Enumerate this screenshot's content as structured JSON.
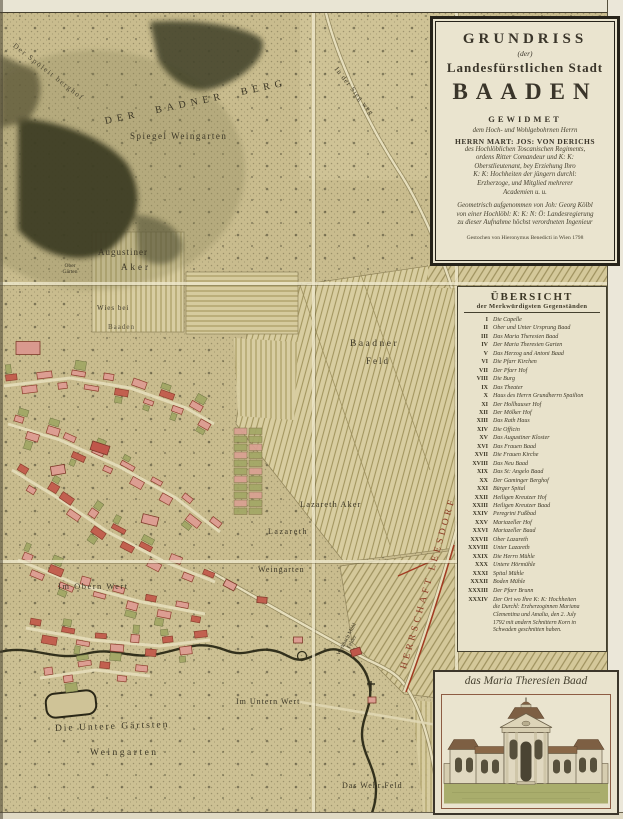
{
  "cartouche": {
    "title_small": "GRUNDRISS",
    "der": "(der)",
    "subtitle": "Landesfürstlichen Stadt",
    "title_main": "BAADEN",
    "gewidmet": "GEWIDMET",
    "dedication_intro": "dem Hoch- und Wohlgebohrnen Herrn",
    "dedicatee": "HERRN MART: JOS: VON DERICHS",
    "dedication_lines": [
      "des Hochlöblichen Toscanischen Regiments,",
      "ordens Ritter Comandeur und K: K:",
      "Oberstlieutenant, bey Erziehung Ihro",
      "K: K: Hochheiten der jüngern durchl:",
      "Erzherzoge, und Mitglied mehrerer",
      "Academien u. u."
    ],
    "surveyor_lines": [
      "Geometrisch aufgenommen von Joh: Georg Kölbl",
      "von einer Hochlöbl: K: K: N: Ö: Landesregierung",
      "zu dieser Aufnahme höchst verordneten Ingenieur"
    ],
    "engraver_line": "Gestochen von Hieronymus Benedicti in Wien 1798"
  },
  "legend": {
    "title": "ÜBERSICHT",
    "subtitle": "der Merkwürdigsten Gegenständen",
    "items": [
      {
        "num": "I",
        "name": "Die Capelle"
      },
      {
        "num": "II",
        "name": "Ober und Unter Ursprung Baad"
      },
      {
        "num": "III",
        "name": "Das Maria Theresien Baad"
      },
      {
        "num": "IV",
        "name": "Der Maria Theresien Garten"
      },
      {
        "num": "V",
        "name": "Das Herzog und Antoni Baad"
      },
      {
        "num": "VI",
        "name": "Die Pfarr Kirchen"
      },
      {
        "num": "VII",
        "name": "Der Pfarr Hof"
      },
      {
        "num": "VIII",
        "name": "Die Burg"
      },
      {
        "num": "IX",
        "name": "Das Theater"
      },
      {
        "num": "X",
        "name": "Haus des Herrn Grundherrn Spailion"
      },
      {
        "num": "XI",
        "name": "Der Hollhauser Hof"
      },
      {
        "num": "XII",
        "name": "Der Mölker Hof"
      },
      {
        "num": "XIII",
        "name": "Das Rath Haus"
      },
      {
        "num": "XIV",
        "name": "Die Officin"
      },
      {
        "num": "XV",
        "name": "Das Augustiner Kloster"
      },
      {
        "num": "XVI",
        "name": "Das Frauen Baad"
      },
      {
        "num": "XVII",
        "name": "Die Frauen Kirche"
      },
      {
        "num": "XVIII",
        "name": "Das Neu Baad"
      },
      {
        "num": "XIX",
        "name": "Das St: Angelo Baad"
      },
      {
        "num": "XX",
        "name": "Der Gaminger Berghof"
      },
      {
        "num": "XXI",
        "name": "Bürger Spital"
      },
      {
        "num": "XXII",
        "name": "Heiligen Kreutzer Hof"
      },
      {
        "num": "XXIII",
        "name": "Heiligen Kreutzer Baad"
      },
      {
        "num": "XXIV",
        "name": "Peregrini Fußbad"
      },
      {
        "num": "XXV",
        "name": "Mariazeller Hof"
      },
      {
        "num": "XXVI",
        "name": "Mariazeller Baad"
      },
      {
        "num": "XXVII",
        "name": "Ober Lazareth"
      },
      {
        "num": "XXVIII",
        "name": "Unter Lazareth"
      },
      {
        "num": "XXIX",
        "name": "Die Herrn Mühle"
      },
      {
        "num": "XXX",
        "name": "Untere Hörmühle"
      },
      {
        "num": "XXXI",
        "name": "Spital Mühle"
      },
      {
        "num": "XXXII",
        "name": "Boden Mühle"
      },
      {
        "num": "XXXIII",
        "name": "Der Pfarr Brunn"
      }
    ],
    "last_item_num": "XXXIV",
    "last_item_first": "Der Ort wo Ihre K: K: Hochheiten",
    "last_item_cont": [
      "die Durchl: Erzherzoginnen Mariana",
      "Clementina und Amalia, den 2. July",
      "1792 mit andern Schnittern Korn in",
      "Schwaden geschnitten haben."
    ]
  },
  "picture": {
    "caption": "das Maria Theresien Baad"
  },
  "map_labels": {
    "spoeleit": "Der Spöleit berghof",
    "berg": "DER BADNER BERG",
    "spiegel": "Spiegel Weingarten",
    "augustiner1": "Augustiner",
    "augustiner2": "Aker",
    "obergarten": "Ober Gärten",
    "wiesbei": "Wies bei",
    "baaden_small": "Baaden",
    "siegweg": "In der Sieg weg",
    "baadner": "Baadner",
    "feld": "Feld",
    "lazareth_aker": "Lazareth Aker",
    "lazareth": "Lazareth",
    "weingarten_mid": "Weingarten",
    "im_obern": "Im Obern Wert",
    "werkbach": "Werkbach Mühl Felder",
    "herrschaft": "HERRSCHAFT LEESDORF",
    "im_untern": "Im Untern Wert",
    "untere1": "Die Untere Gärtsten",
    "untere2": "Weingarten",
    "wehrfeld": "Das Wehr Feld"
  },
  "colors": {
    "paper": "#c9bc8e",
    "panel": "#e9e3cd",
    "building": "#dc9e92",
    "building_dark": "#c2604f",
    "garden": "#a2a765",
    "boundary_red": "#a23b22",
    "ink": "#3c3726"
  }
}
